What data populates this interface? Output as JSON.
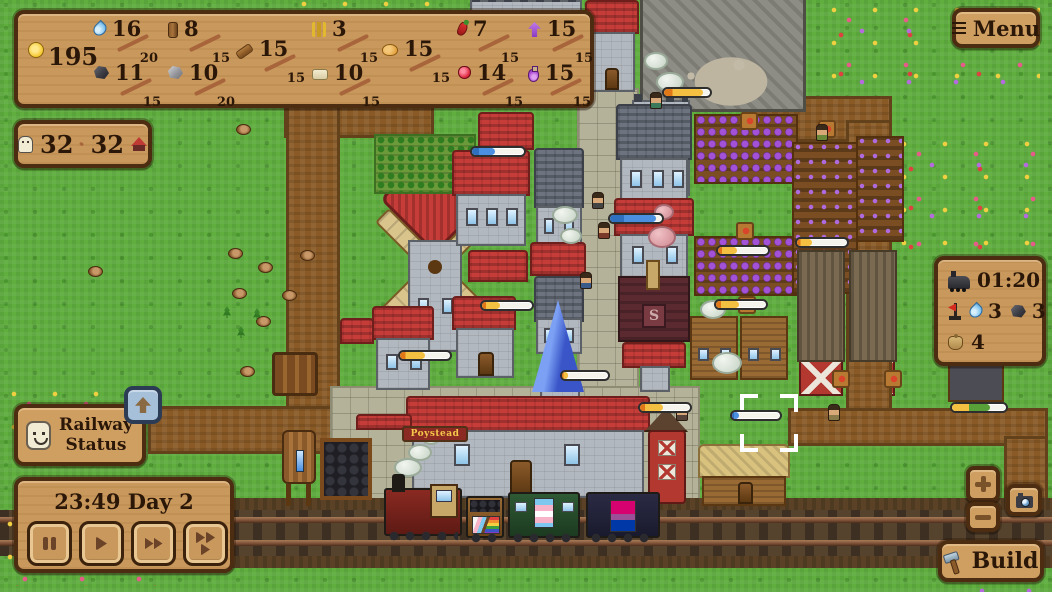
{
  "hud": {
    "coins": "195",
    "resources": {
      "water": {
        "num": "16",
        "den": "20"
      },
      "log": {
        "num": "8",
        "den": "15"
      },
      "plank": {
        "num": "15",
        "den": "15"
      },
      "wheat": {
        "num": "3",
        "den": "15"
      },
      "bread": {
        "num": "15",
        "den": "15"
      },
      "pepper": {
        "num": "7",
        "den": "15"
      },
      "purple_carrot": {
        "num": "15",
        "den": "15"
      },
      "coal": {
        "num": "11",
        "den": "15"
      },
      "stone": {
        "num": "10",
        "den": "20"
      },
      "cloth": {
        "num": "10",
        "den": "15"
      },
      "berry": {
        "num": "14",
        "den": "15"
      },
      "potion": {
        "num": "15",
        "den": "15"
      }
    },
    "population": {
      "current": "32",
      "max": "32"
    }
  },
  "buttons": {
    "menu": "Menu",
    "build": "Build",
    "railway_status_line1": "Railway",
    "railway_status_line2": "Status"
  },
  "train_panel": {
    "next_train_time": "01:20",
    "water": "3",
    "coal": "3",
    "cargo": "4"
  },
  "time_panel": {
    "clock": "23:49 Day 2"
  },
  "station": {
    "name": "Poystead"
  },
  "colors": {
    "panel": "#c9985c",
    "panel_border": "#4c2d11",
    "text": "#2b1708",
    "bar_yellow": "#f4c041",
    "bar_blue": "#4a8fe0",
    "blue_button": "#a7c0da"
  }
}
